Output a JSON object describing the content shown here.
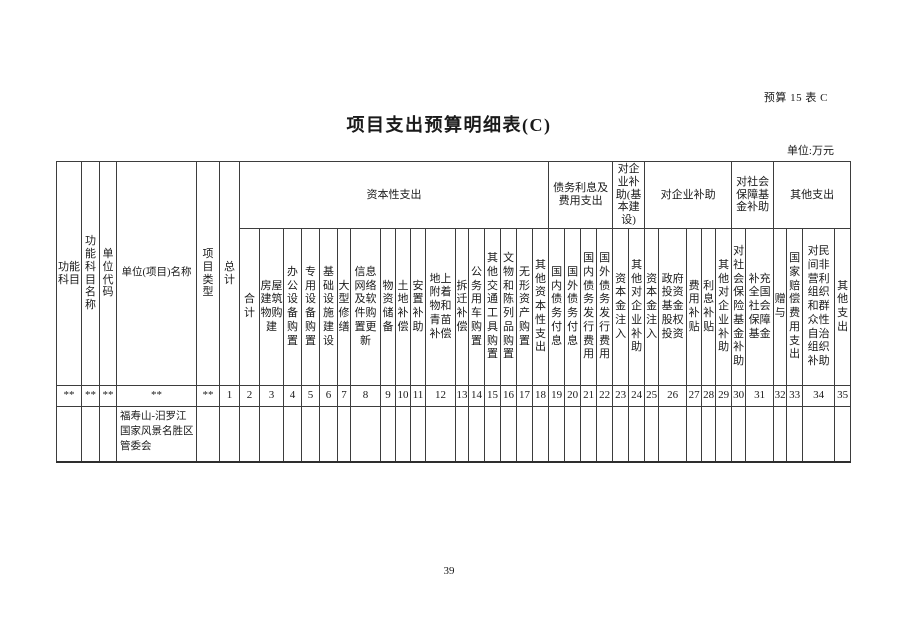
{
  "doc": {
    "ref": "预算 15 表 C",
    "title": "项目支出预算明细表(C)",
    "unit_note": "单位:万元",
    "page_number": "39"
  },
  "table": {
    "left_columns": [
      {
        "label": "功能科目",
        "num": "**"
      },
      {
        "label": "功能科目名称",
        "num": "**"
      },
      {
        "label": "单位代码",
        "num": "**"
      },
      {
        "label": "单位(项目)名称",
        "num": "**"
      },
      {
        "label": "项目类型",
        "num": "**"
      },
      {
        "label": "总计",
        "num": "1"
      }
    ],
    "groups": [
      {
        "label": "资本性支出",
        "columns": [
          {
            "label": "合计",
            "num": "2"
          },
          {
            "label": "房屋建筑物购建",
            "num": "3"
          },
          {
            "label": "办公设备购置",
            "num": "4"
          },
          {
            "label": "专用设备购置",
            "num": "5"
          },
          {
            "label": "基础设施建设",
            "num": "6"
          },
          {
            "label": "大型修缮",
            "num": "7"
          },
          {
            "label": "信息网络及软件购置更新",
            "num": "8"
          },
          {
            "label": "物资储备",
            "num": "9"
          },
          {
            "label": "土地补偿",
            "num": "10"
          },
          {
            "label": "安置补助",
            "num": "11"
          },
          {
            "label": "地上附着物和青苗补偿",
            "num": "12"
          },
          {
            "label": "拆迁补偿",
            "num": "13"
          },
          {
            "label": "公务用车购置",
            "num": "14"
          },
          {
            "label": "其他交通工具购置",
            "num": "15"
          },
          {
            "label": "文物和陈列品购置",
            "num": "16"
          },
          {
            "label": "无形资产购置",
            "num": "17"
          },
          {
            "label": "其他资本性支出",
            "num": "18"
          }
        ]
      },
      {
        "label": "债务利息及费用支出",
        "columns": [
          {
            "label": "国内债务付息",
            "num": "19"
          },
          {
            "label": "国外债务付息",
            "num": "20"
          },
          {
            "label": "国内债务发行费用",
            "num": "21"
          },
          {
            "label": "国外债务发行费用",
            "num": "22"
          }
        ]
      },
      {
        "label": "对企业补助(基本建设)",
        "columns": [
          {
            "label": "资本金注入",
            "num": "23"
          },
          {
            "label": "其他对企业补助",
            "num": "24"
          }
        ]
      },
      {
        "label": "对企业补助",
        "columns": [
          {
            "label": "资本金注入",
            "num": "25"
          },
          {
            "label": "政府投资基金股权投资",
            "num": "26"
          },
          {
            "label": "费用补贴",
            "num": "27"
          },
          {
            "label": "利息补贴",
            "num": "28"
          },
          {
            "label": "其他对企业补助",
            "num": "29"
          }
        ]
      },
      {
        "label": "对社会保障基金补助",
        "columns": [
          {
            "label": "对社会保险基金补助",
            "num": "30"
          },
          {
            "label": "补充全国社会保障基金",
            "num": "31"
          }
        ]
      },
      {
        "label": "其他支出",
        "columns": [
          {
            "label": "赠与",
            "num": "32"
          },
          {
            "label": "国家赔偿费用支出",
            "num": "33"
          },
          {
            "label": "对民间非营利组织和群众性自治组织补助",
            "num": "34"
          },
          {
            "label": "其他支出",
            "num": "35"
          }
        ]
      }
    ],
    "rows": [
      {
        "unit_name": "福寿山-汨罗江国家风景名胜区管委会"
      }
    ]
  }
}
